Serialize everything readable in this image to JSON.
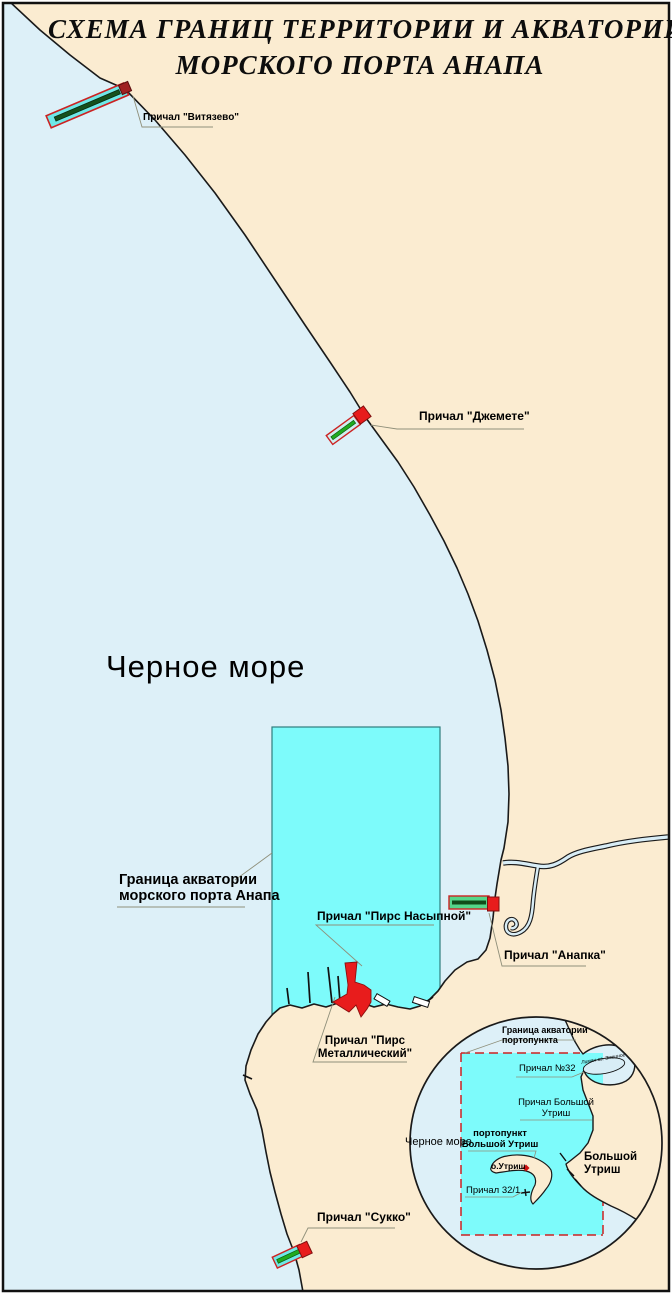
{
  "colors": {
    "sea": "#ddf0f8",
    "land": "#fbecd1",
    "aquatory": "#7dfbfb",
    "aquatory_border": "#2f7d7d",
    "boundary_red": "#cc2222",
    "pier_red": "#e81c1c",
    "coast": "#1a1a1a",
    "river": "#d8edf6"
  },
  "title": {
    "line1": "СХЕМА ГРАНИЦ ТЕРРИТОРИИ И АКВАТОРИИ",
    "line2": "МОРСКОГО ПОРТА  АНАПА"
  },
  "sea_label": "Черное море",
  "labels": {
    "vityazevo": "Причал \"Витязево\"",
    "dzhemete": "Причал \"Джемете\"",
    "anapka": "Причал \"Анапка\"",
    "sukko": "Причал \"Сукко\"",
    "pirs_nasypnoy": "Причал \"Пирс Насыпной\"",
    "pirs_metallicheskiy": "Причал \"Пирс\nМеталлический\"",
    "akvatoria": "Граница акватории\nморского порта Анапа"
  },
  "inset": {
    "granitsa": "Граница акватории\nпортопункта",
    "prichal32": "Причал №32",
    "prichal_bolshoy_utrish": "Причал Большой\nУтриш",
    "portopunkt": "портопункт\nБольшой Утриш",
    "ostrov": "о.Утриш",
    "prichal321": "Причал 32/1",
    "bolshoy_utrish": "Большой Утриш",
    "sea": "Черное море",
    "lagoon": "Лиман оз. Змеиное"
  }
}
